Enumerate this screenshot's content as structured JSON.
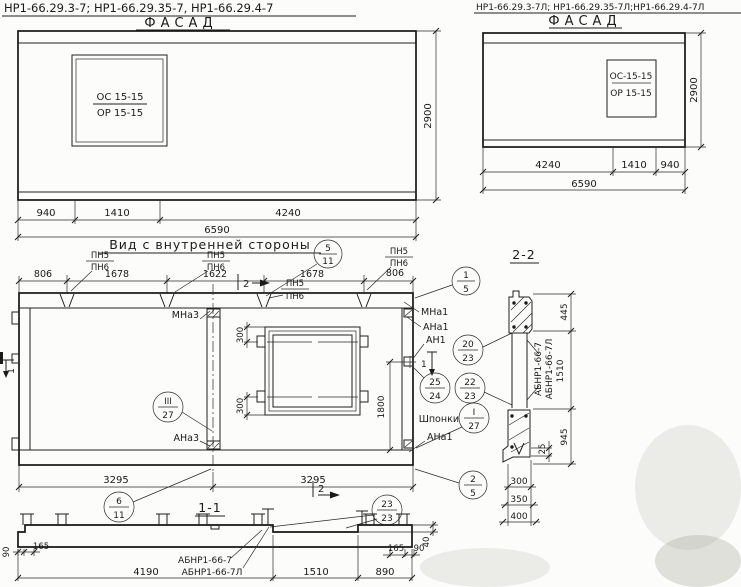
{
  "left_sheet": {
    "code_line": "НР1-66.29.3-7;  НР1-66.29.35-7,  НР1-66.29.4-7",
    "facade_title": "ФАСАД",
    "window_mark_top": "ОС 15-15",
    "window_mark_bottom": "ОР 15-15",
    "height_dim": "2900",
    "dims_row1": [
      "940",
      "1410",
      "4240"
    ],
    "dim_total": "6590"
  },
  "right_sheet": {
    "code_line": "НР1-66.29.3-7Л; НР1-66.29.35-7Л;НР1-66.29.4-7Л",
    "facade_title": "ФАСАД",
    "window_mark_top": "ОС-15-15",
    "window_mark_bottom": "ОР 15-15",
    "height_dim": "2900",
    "dims_row1": [
      "4240",
      "1410",
      "940"
    ],
    "dim_total": "6590"
  },
  "inner_view": {
    "title": "Вид с внутренней стороны",
    "dims_top": [
      "806",
      "1678",
      "1622",
      "1678",
      "806"
    ],
    "pn5": "ПН5",
    "pn6": "ПН6",
    "labels": {
      "mna3": "МНа3",
      "ana3": "АНа3",
      "mna1": "МНа1",
      "ana1": "АНа1",
      "an1": "АН1",
      "ana1_bottom": "АНа1",
      "shponki": "Шпонки"
    },
    "window_dims": {
      "side_top": "300",
      "side_bottom": "300",
      "height": "1800"
    },
    "dims_bottom": [
      "3295",
      "3295"
    ],
    "marker1": "1",
    "marker2": "2",
    "callouts": {
      "title_5_11": {
        "top": "5",
        "bottom": "11"
      },
      "c1_5": {
        "top": "1",
        "bottom": "5"
      },
      "c20_23": {
        "top": "20",
        "bottom": "23"
      },
      "c25_24": {
        "top": "25",
        "bottom": "24"
      },
      "c22_23": {
        "top": "22",
        "bottom": "23"
      },
      "cI_27": {
        "top": "I",
        "bottom": "27"
      },
      "cIII_27": {
        "top": "III",
        "bottom": "27"
      },
      "c2_5": {
        "top": "2",
        "bottom": "5"
      },
      "c6_11": {
        "top": "6",
        "bottom": "11"
      },
      "c23_23": {
        "top": "23",
        "bottom": "23"
      }
    }
  },
  "section22": {
    "title": "2-2",
    "dim_445": "445",
    "dim_1510": "1510",
    "dim_945": "945",
    "dim_25": "25",
    "label_a": "АБНР1-66-7",
    "label_b": "АБНР1-66-7Л",
    "dims_bottom": [
      "300",
      "350",
      "400"
    ]
  },
  "section11": {
    "title": "1-1",
    "dim_90l": "90",
    "dim_165l": "165",
    "dim_4190": "4190",
    "dim_1510": "1510",
    "dim_890": "890",
    "dim_165r": "165",
    "dim_90r": "90",
    "dim_40": "40",
    "label_a": "АБНР1-66-7",
    "label_b": "АБНР1-66-7Л"
  }
}
